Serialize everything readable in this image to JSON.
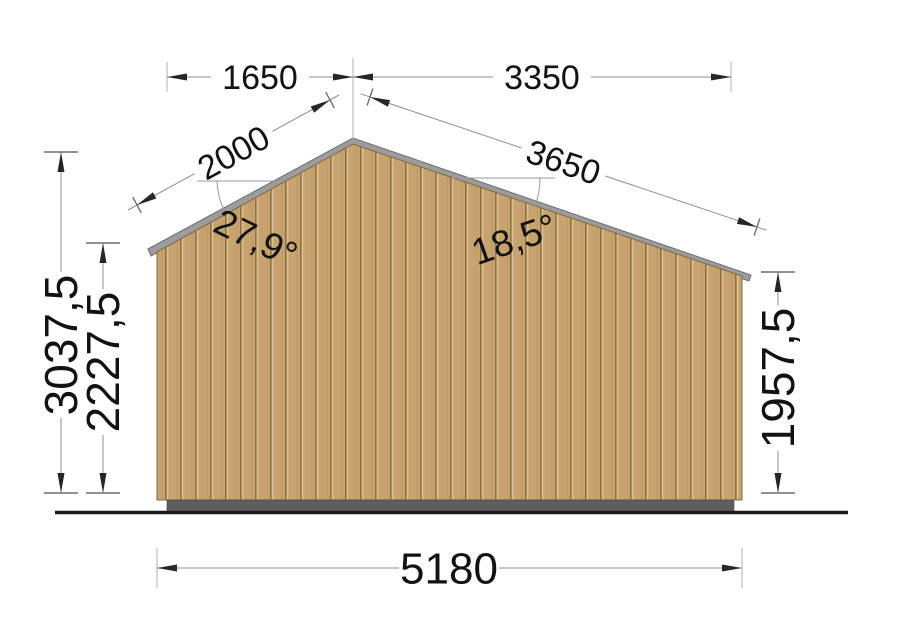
{
  "drawing": {
    "type": "house-gable-elevation",
    "labels": {
      "top_left_width": "1650",
      "top_right_width": "3350",
      "left_roof_slope": "2000",
      "right_roof_slope": "3650",
      "left_roof_angle": "27,9°",
      "right_roof_angle": "18,5°",
      "overall_height": "3037,5",
      "left_wall_height": "2227,5",
      "right_wall_height": "1957,5",
      "overall_width": "5180"
    },
    "colors": {
      "wood_base": "#c7a36f",
      "wood_groove": "#8d7144",
      "wood_highlight": "#dcbf8c",
      "wood_shade": "#b6924f",
      "roof_fascia": "#9c9c9c",
      "foundation": "#5e5e5e",
      "ground": "#1c1c1c"
    }
  }
}
